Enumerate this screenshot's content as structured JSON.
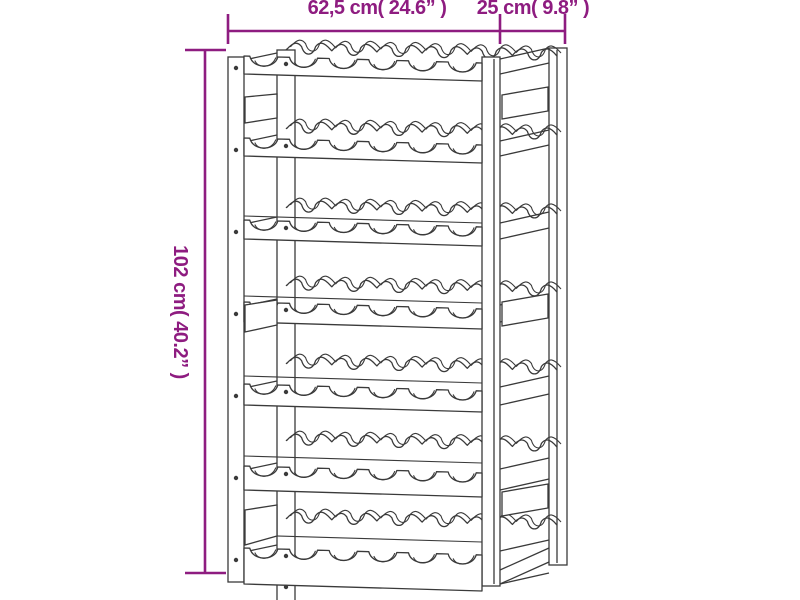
{
  "title": "Wine rack dimension diagram",
  "dimensions": {
    "color": "#8e1c80",
    "width_label": "62,5 cm( 24.6” )",
    "depth_label": "25 cm( 9.8” )",
    "height_label": "102 cm( 40.2” )"
  },
  "rack": {
    "stroke": "#3a3a3a",
    "stroke_width": 1.3,
    "fill": "#ffffff",
    "rows": 7,
    "slots_per_row": 6,
    "total_slots": 42,
    "row_tops": [
      56,
      138,
      220,
      302,
      384,
      466,
      548
    ],
    "rail_heights": [
      18,
      18,
      19,
      20,
      21,
      24,
      36
    ],
    "back_sep": [
      7,
      10,
      13,
      17,
      21,
      26,
      30
    ],
    "face_gap": [
      0,
      0,
      4,
      6,
      8,
      10,
      13
    ],
    "row_slope": 7,
    "front_rail_x": [
      244,
      482
    ],
    "back_rail_x": [
      286,
      557
    ],
    "notch_radius": 13,
    "posts": {
      "front_left": {
        "x": 228,
        "y": 57,
        "w": 16,
        "h": 525
      },
      "back_left": {
        "x": 277,
        "y": 50,
        "w": 18,
        "h": 552
      },
      "front_right": {
        "x": 482,
        "y": 57,
        "w": 18,
        "h": 529,
        "inner_line_x": 494
      },
      "back_right": {
        "x": 549,
        "y": 48,
        "w": 18,
        "h": 517,
        "inner_line_x": 557
      }
    },
    "left_blocks": [
      [
        [
          245,
          97
        ],
        [
          277,
          94
        ],
        [
          277,
          118
        ],
        [
          245,
          123
        ]
      ],
      [
        [
          245,
          305
        ],
        [
          277,
          300
        ],
        [
          277,
          325
        ],
        [
          245,
          332
        ]
      ],
      [
        [
          245,
          510
        ],
        [
          277,
          505
        ],
        [
          277,
          536
        ],
        [
          245,
          545
        ]
      ]
    ],
    "right_blocks": [
      [
        [
          502,
          95
        ],
        [
          548,
          87
        ],
        [
          548,
          111
        ],
        [
          502,
          119
        ]
      ],
      [
        [
          502,
          302
        ],
        [
          548,
          294
        ],
        [
          548,
          318
        ],
        [
          502,
          326
        ]
      ],
      [
        [
          502,
          492
        ],
        [
          548,
          484
        ],
        [
          548,
          508
        ],
        [
          502,
          516
        ]
      ]
    ],
    "screws": {
      "front_left_x": 236,
      "back_left_x": 286,
      "front_left_y": [
        68,
        150,
        232,
        314,
        396,
        478,
        560
      ],
      "back_left_y": [
        64,
        146,
        228,
        310,
        392,
        474,
        556,
        587
      ]
    }
  },
  "dim_geometry": {
    "h_line": {
      "y": 31,
      "x1": 228,
      "x2": 565
    },
    "h_ticks": [
      228,
      500,
      565
    ],
    "tick_y1": 14,
    "tick_y2": 44,
    "v_line": {
      "x": 205,
      "y1": 50,
      "y2": 573
    },
    "cap_x1": 185,
    "cap_x2": 226,
    "line_width": 2.6
  }
}
